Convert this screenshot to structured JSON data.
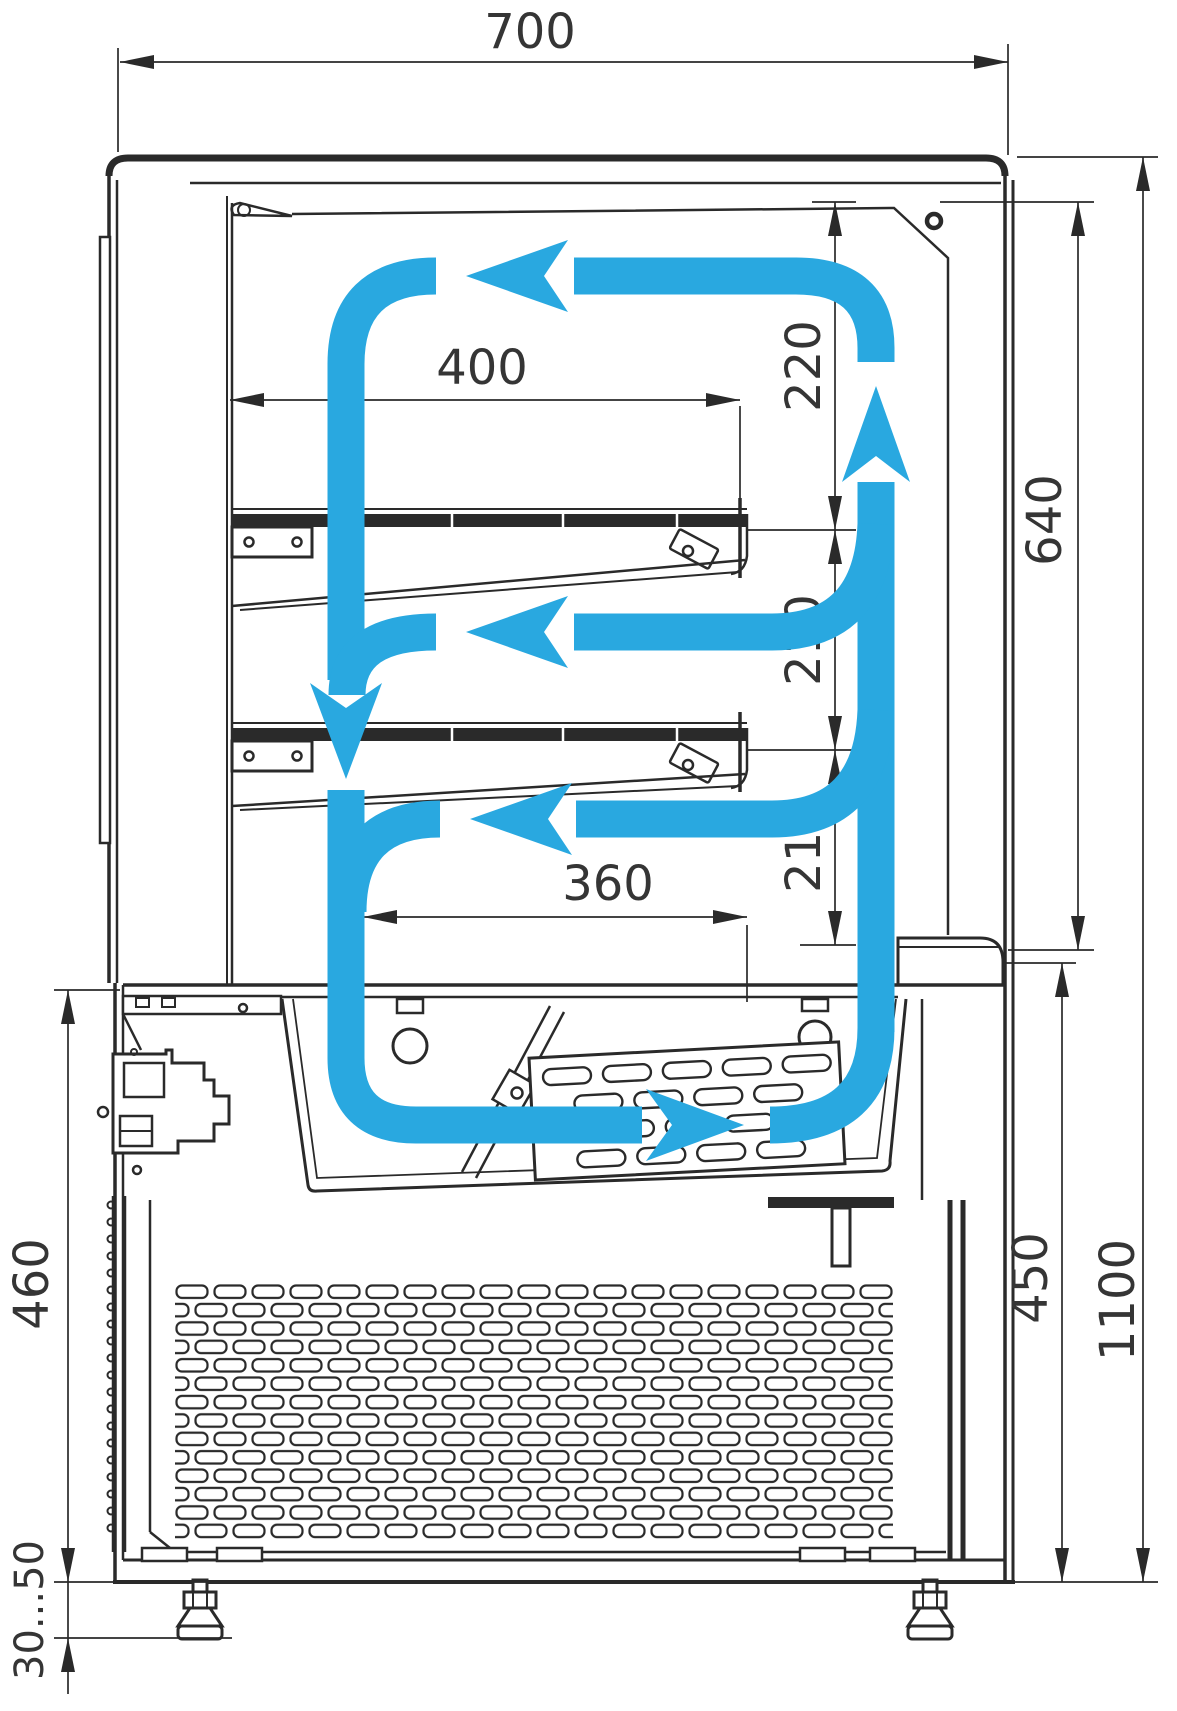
{
  "title": "refrigerated-display-case-side-section-drawing",
  "dimensions": {
    "overall_width": "700",
    "shelf_depth": "400",
    "deck_opening": "360",
    "clearance_top": "220",
    "clearance_middle": "210",
    "clearance_lower": "210",
    "chamber_height": "640",
    "overall_height": "1100",
    "base_height_rear": "460",
    "base_height_front": "450",
    "leg_adjust_range": "30...50"
  },
  "colors": {
    "airflow": "#29a8e0",
    "drawing_line": "#2a2a2a",
    "dimension_text": "#353535"
  },
  "icons": {
    "airflow_arrows": "air-circulation-loop",
    "perforated_grille": "condenser-vent-grille",
    "adjustable_feet": "leveling-feet"
  }
}
